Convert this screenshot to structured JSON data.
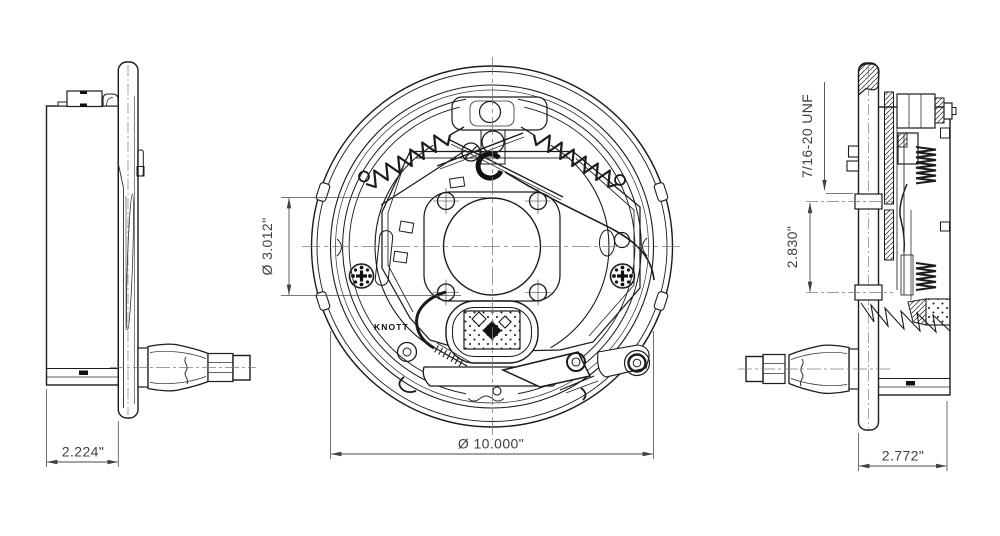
{
  "drawing": {
    "type": "engineering-drawing",
    "subject": "trailer drum brake assembly, three orthographic views",
    "brand_label": "KNOTT",
    "views": {
      "left": {
        "title": "left-side-view",
        "dim_mounting_depth": "2.224\""
      },
      "front": {
        "title": "front-view",
        "dim_hub_bore": "Ø 3.012\"",
        "dim_drum_diameter": "Ø 10.000\""
      },
      "right": {
        "title": "right-section-view",
        "dim_stud_thread": "7/16-20 UNF",
        "dim_stud_spacing": "2.830\"",
        "dim_overall_depth": "2.772\""
      }
    }
  }
}
